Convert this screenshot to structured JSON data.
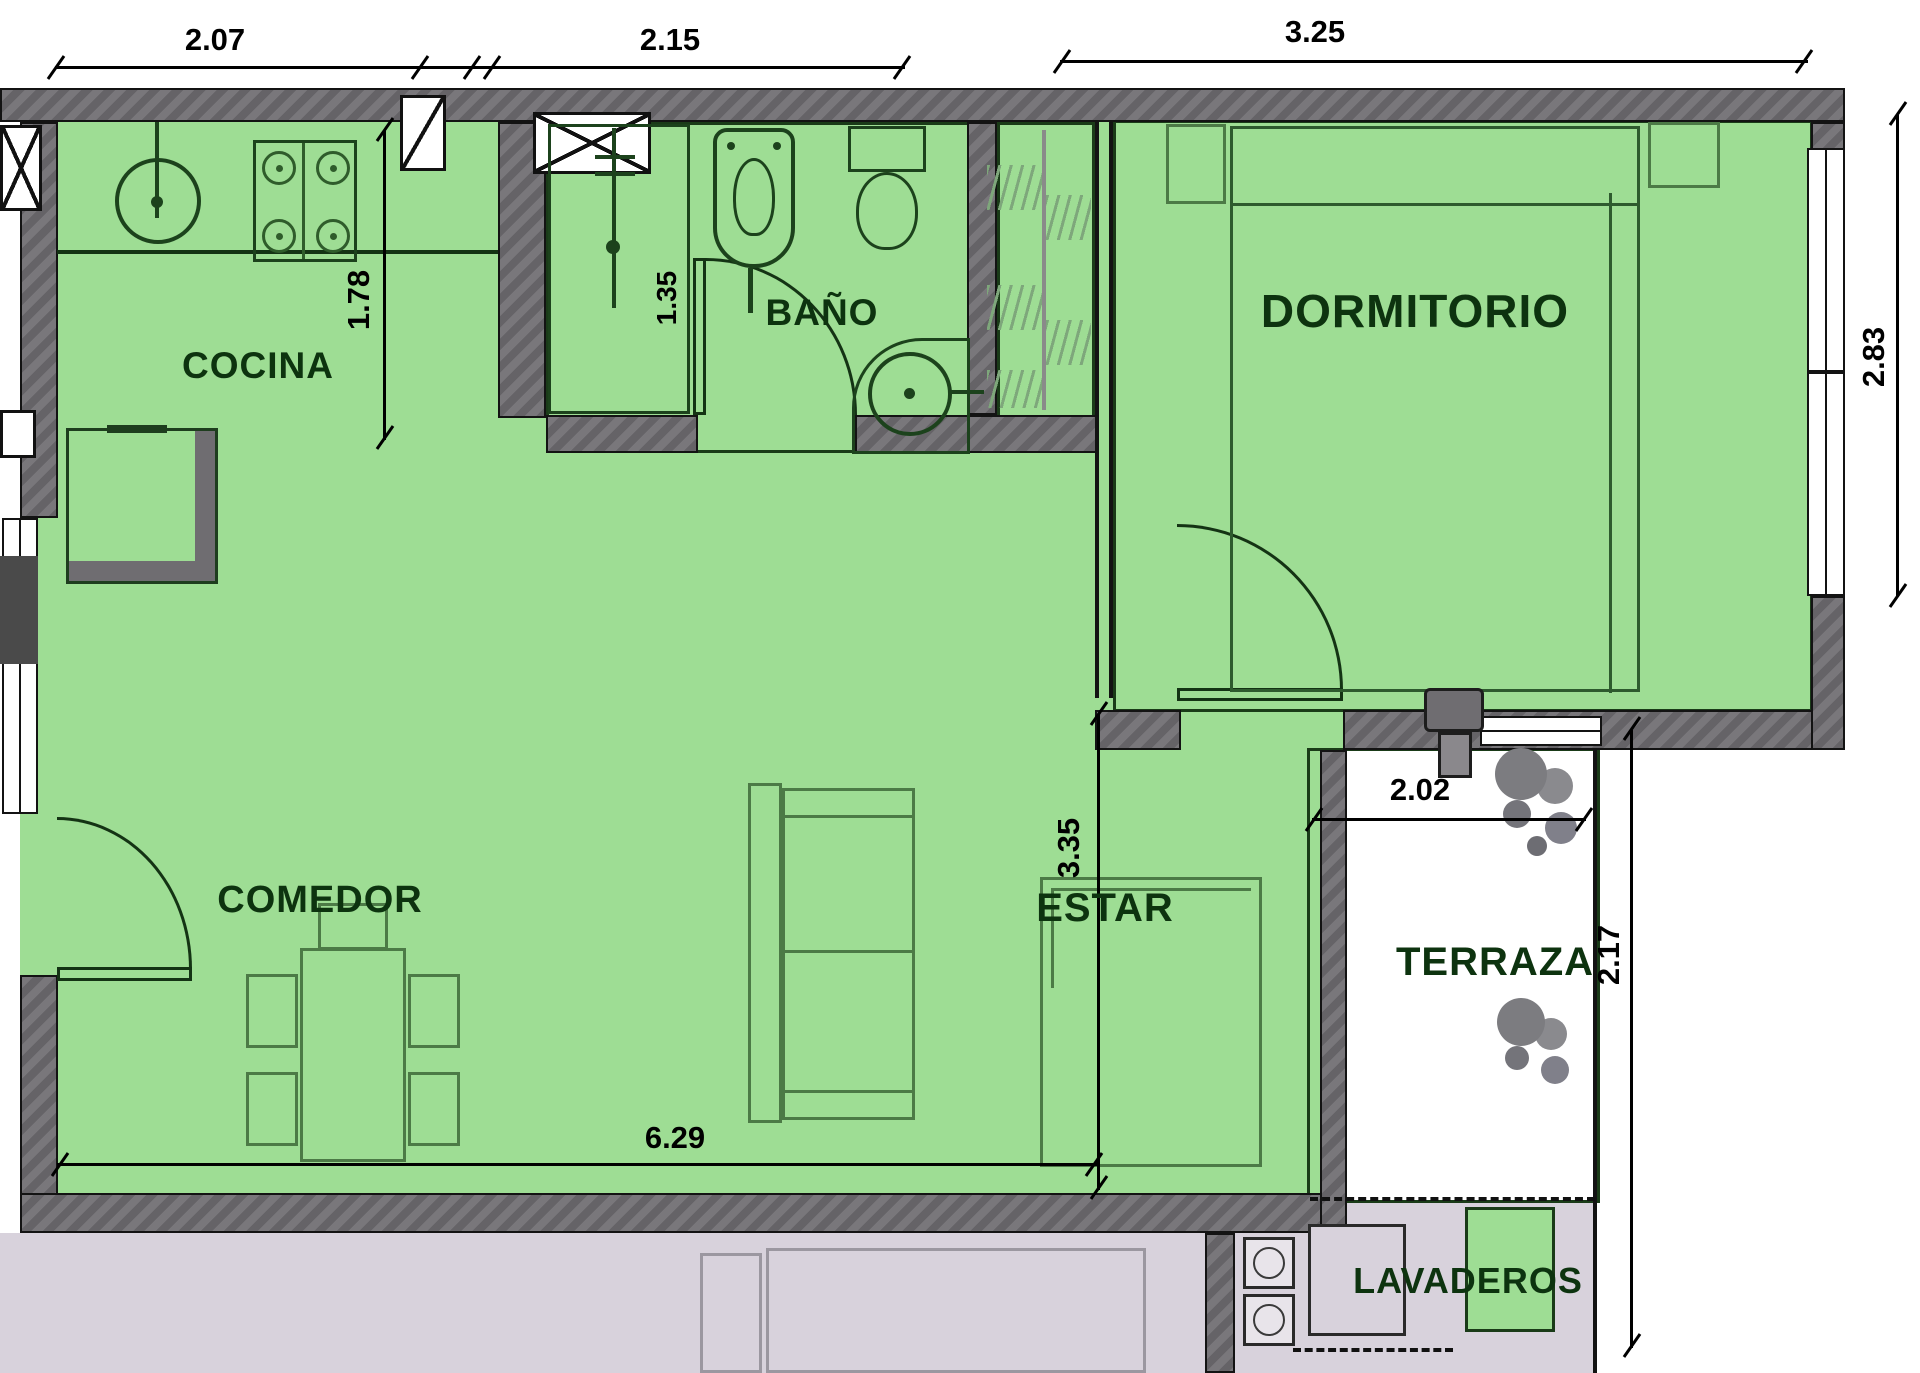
{
  "plan_title": "apartment-floor-plan",
  "rooms": {
    "cocina": {
      "label": "COCINA"
    },
    "bano": {
      "label": "BAÑO"
    },
    "dormitorio": {
      "label": "DORMITORIO"
    },
    "comedor": {
      "label": "COMEDOR"
    },
    "estar": {
      "label": "ESTAR"
    },
    "terraza": {
      "label": "TERRAZA"
    },
    "lavaderos": {
      "label": "LAVADEROS"
    }
  },
  "dimensions": {
    "cocina_width": {
      "value": "2.07"
    },
    "bano_width": {
      "value": "2.15"
    },
    "dormitorio_width": {
      "value": "3.25"
    },
    "dormitorio_height": {
      "value": "2.83"
    },
    "terraza_height": {
      "value": "2.17"
    },
    "cocina_depth": {
      "value": "1.78"
    },
    "bano_depth": {
      "value": "1.35"
    },
    "estar_depth": {
      "value": "3.35"
    },
    "living_width": {
      "value": "6.29"
    },
    "terraza_width": {
      "value": "2.02"
    }
  },
  "colors": {
    "floor_green": "#9edd94",
    "terrace_stripe_light": "#c6ebbf",
    "terrace_stripe_dark": "#93d88a",
    "wall_gray": "#6f6d71",
    "outside_lavender": "#d8d2dc",
    "line_black": "#131313",
    "label_dark_green": "#0d330f",
    "furniture_green": "#4c7a46"
  },
  "fixtures": [
    "kitchen-sink",
    "stove",
    "refrigerator",
    "vent-shaft",
    "shower",
    "bidet",
    "toilet",
    "washbasin",
    "closet-hatch",
    "double-bed",
    "nightstand",
    "air-conditioner",
    "entry-door",
    "bath-door",
    "bedroom-door",
    "sofa",
    "rug",
    "dining-table",
    "dining-chair",
    "plant",
    "washing-machine",
    "laundry-sink"
  ]
}
